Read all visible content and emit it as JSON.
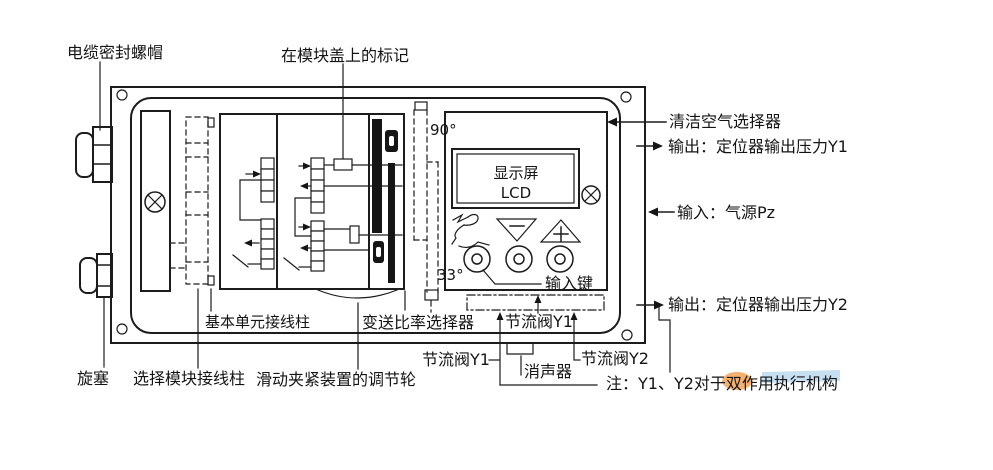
{
  "colors": {
    "ink": "#1c1c1c",
    "background": "#ffffff",
    "watermark_orange": "#f09d4e",
    "watermark_blue": "#aed3ec"
  },
  "labels": {
    "cable_gland": "电缆密封螺帽",
    "module_cover_mark": "在模块盖上的标记",
    "angle_90": "90°",
    "angle_33": "33°",
    "display_name": "显示屏",
    "display_type": "LCD",
    "clean_air_selector": "清洁空气选择器",
    "output_y1": "输出：定位器输出压力Y1",
    "input_pz": "输入：气源Pz",
    "output_y2": "输出：定位器输出压力Y2",
    "input_keys": "输入键",
    "base_unit_terminals": "基本单元接线柱",
    "ratio_selector": "变送比率选择器",
    "throttle_y1_panel": "节流阀Y1",
    "throttle_y1_left": "节流阀Y1",
    "muffler": "消声器",
    "throttle_y2": "节流阀Y2",
    "note": "注：Y1、Y2对于双作用执行机构",
    "plug": "旋塞",
    "option_module_terminals": "选择模块接线柱",
    "clamp_wheel": "滑动夹紧装置的调节轮"
  }
}
